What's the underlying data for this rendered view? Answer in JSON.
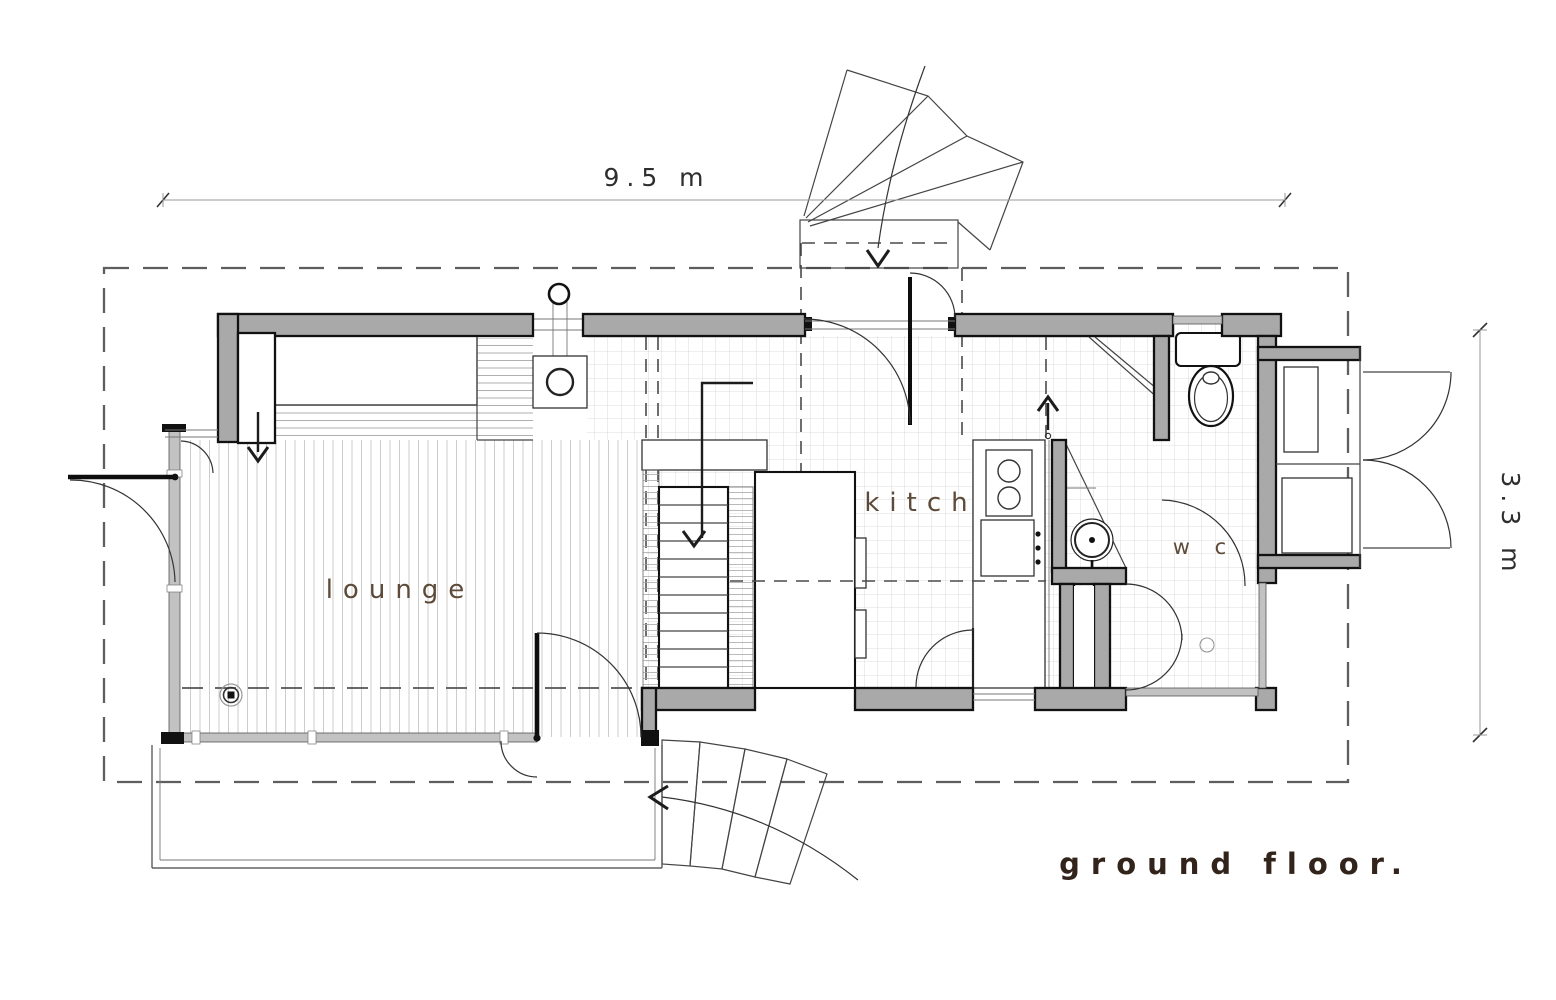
{
  "title": {
    "text": "ground floor."
  },
  "rooms": {
    "lounge": {
      "label": "lounge"
    },
    "kitchen": {
      "label": "kitch"
    },
    "wc": {
      "label": "w c"
    }
  },
  "dimensions": {
    "width": {
      "label": "9.5 m"
    },
    "depth": {
      "label": "3.3 m"
    }
  },
  "colors": {
    "wall_fill": "#a9a9a9",
    "wall_stroke": "#111111",
    "glass_fill": "#c2c2c2",
    "label_brown": "#5d4a39",
    "title_brown": "#33241b",
    "plank_line": "#c8c8c8",
    "tile_line": "#d2d2d2",
    "dash_gray": "#5e5e5e",
    "line_dark": "#1c1c1c"
  }
}
